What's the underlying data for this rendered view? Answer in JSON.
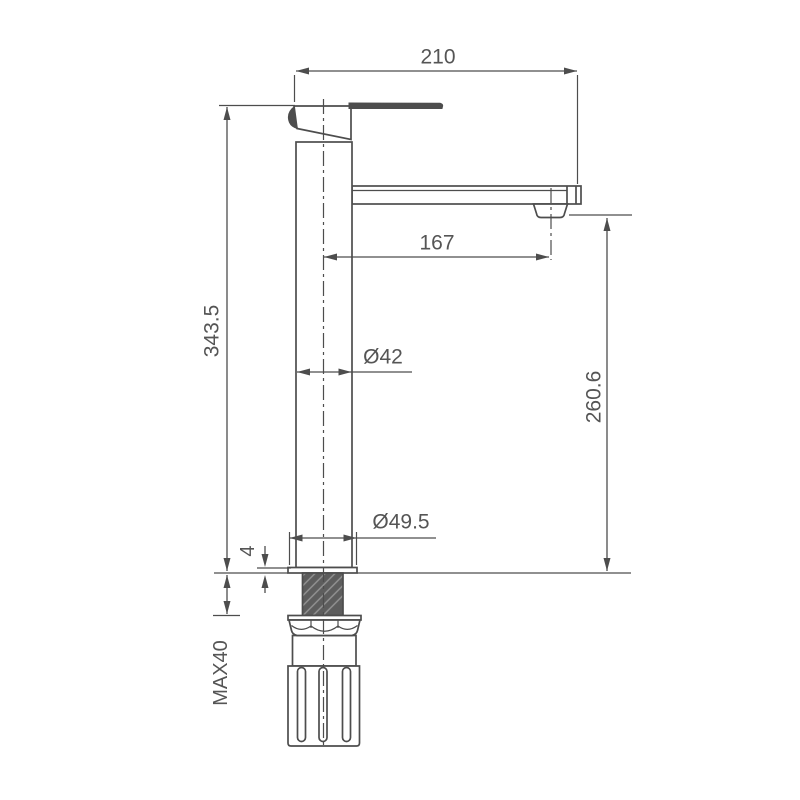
{
  "drawing": {
    "description": "faucet-technical-dimension-drawing",
    "background_color": "#ffffff",
    "line_color": "#4d4d4d",
    "text_color": "#555555",
    "dimensions": {
      "top_width": {
        "label": "210"
      },
      "spout_reach": {
        "label": "167"
      },
      "overall_height": {
        "label": "343.5"
      },
      "outlet_height": {
        "label": "260.6"
      },
      "body_diameter": {
        "label": "Ø42"
      },
      "base_diameter": {
        "label": "Ø49.5"
      },
      "flange_thickness": {
        "label": "4"
      },
      "max_counter_thickness": {
        "label": "MAX40"
      }
    }
  }
}
